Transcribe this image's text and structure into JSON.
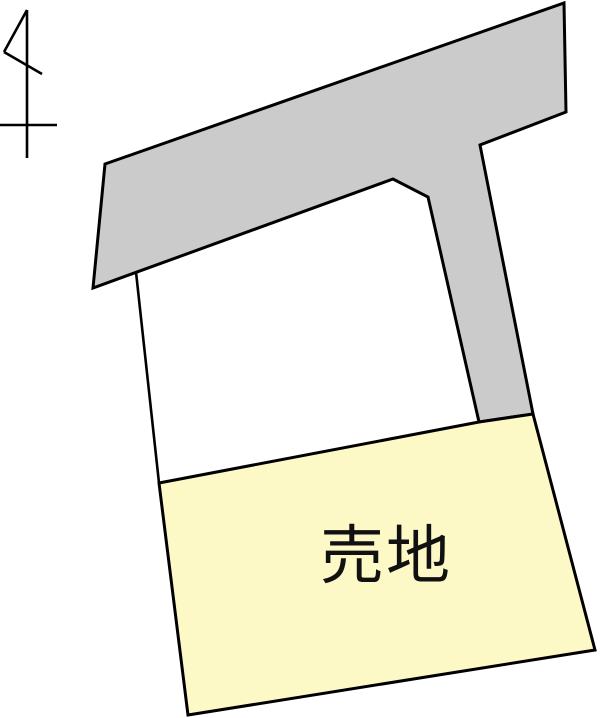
{
  "map": {
    "title": "land-plot-map",
    "parcel": {
      "label": "売地",
      "fill": "#fcf9c6"
    },
    "road": {
      "fill": "#cbcbcb"
    },
    "outline_color": "#000000",
    "background_color": "#ffffff",
    "compass": {
      "name": "north-arrow",
      "stroke": "#000000"
    }
  }
}
